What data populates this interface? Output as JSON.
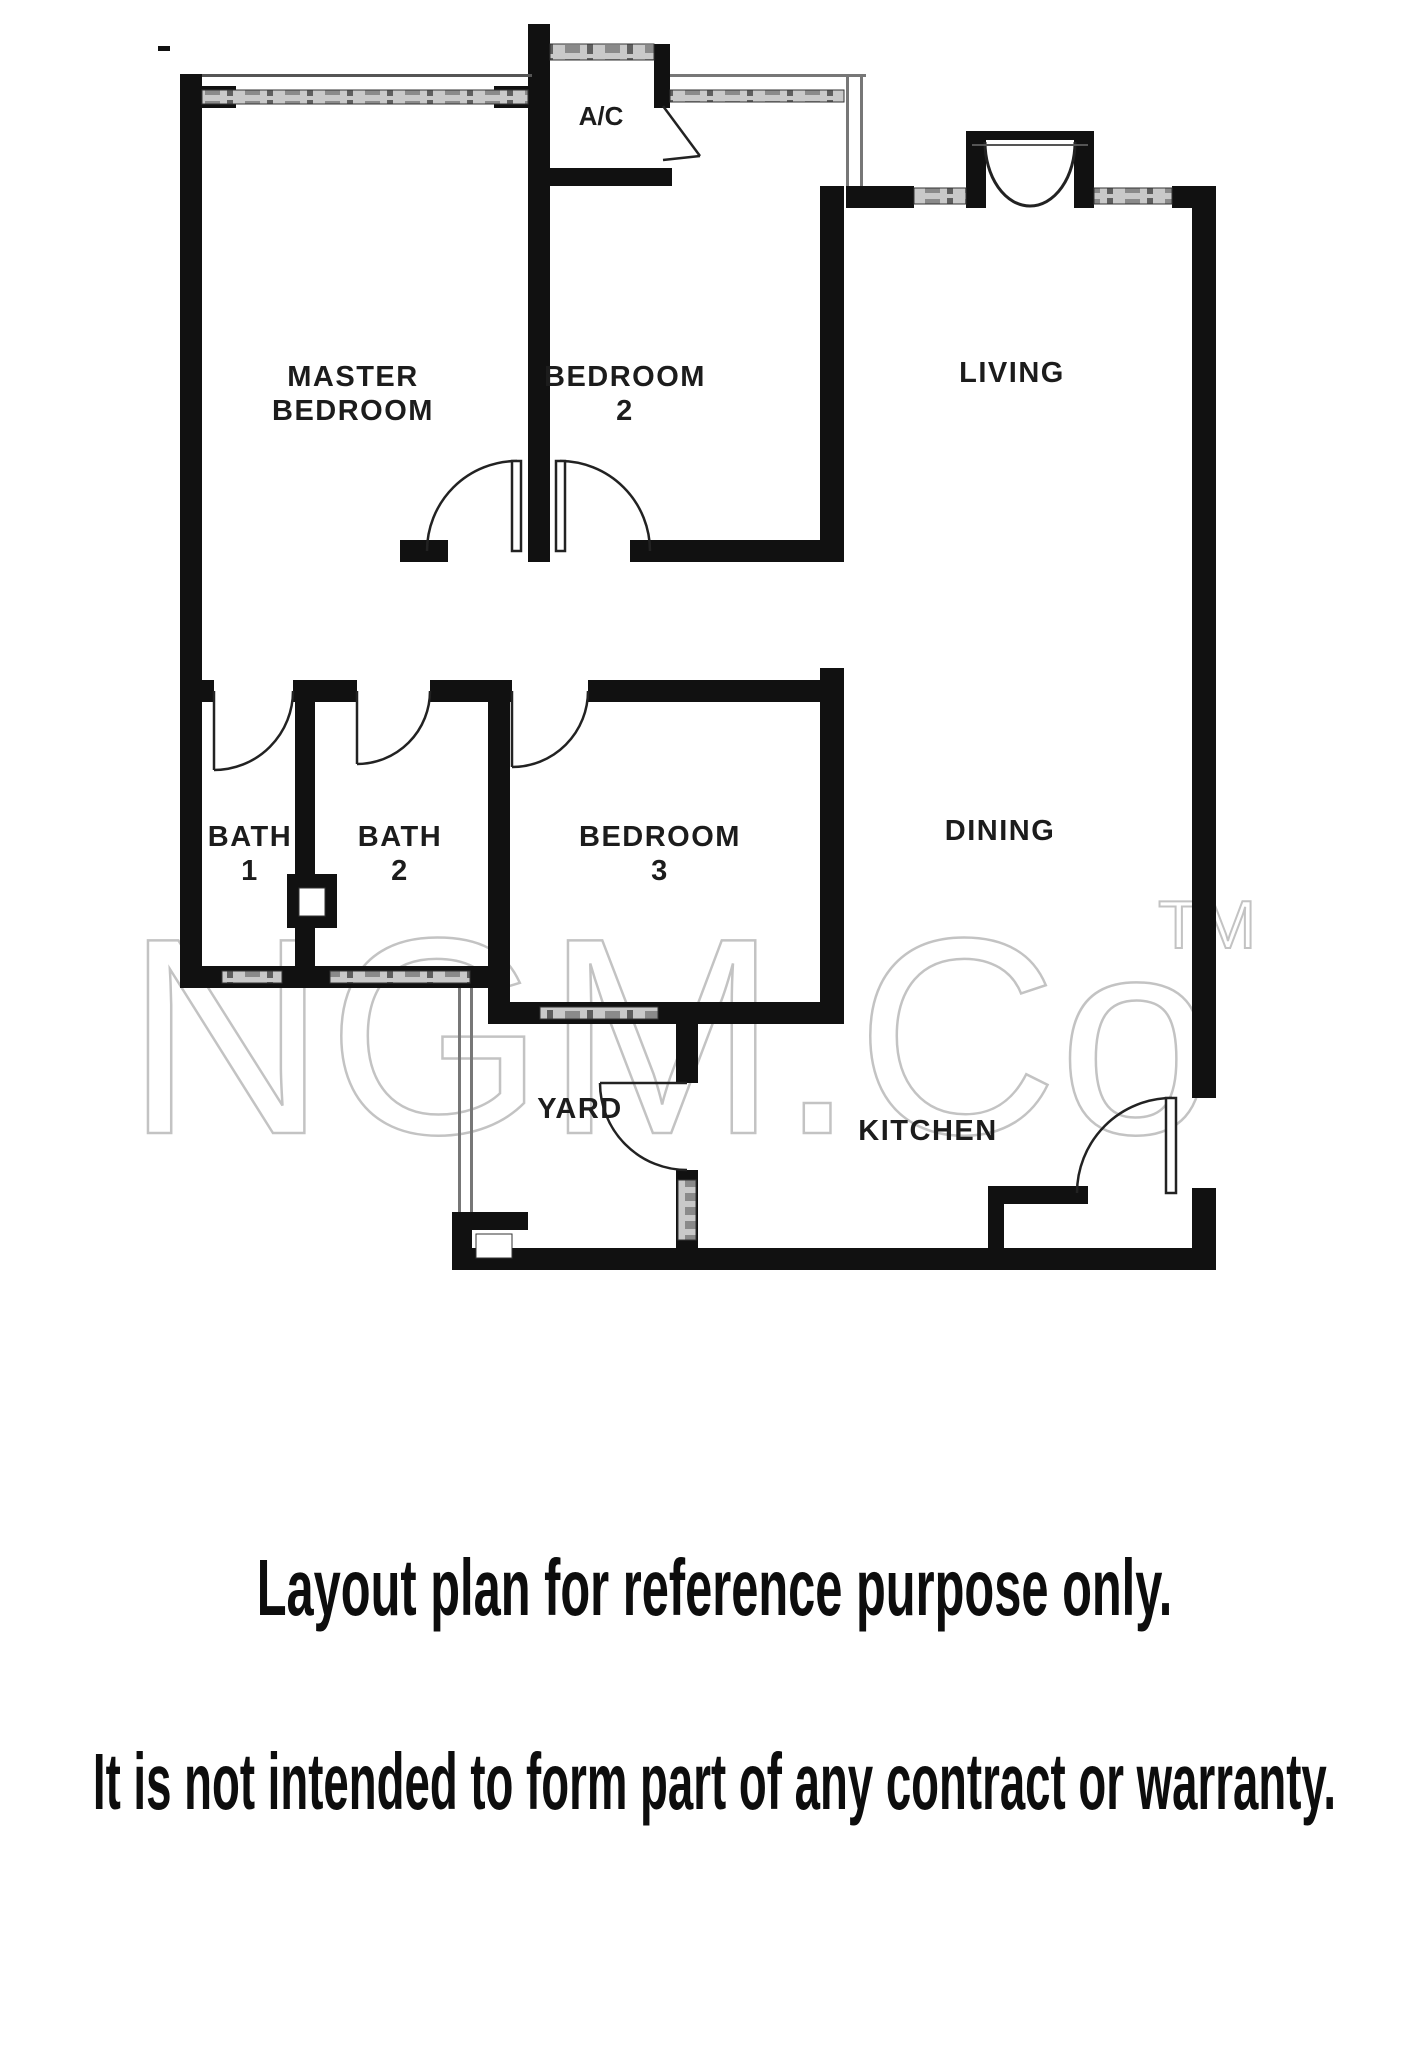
{
  "plan": {
    "ac_label": "A/C",
    "rooms": {
      "master_bedroom": {
        "line1": "MASTER",
        "line2": "BEDROOM"
      },
      "bedroom2": {
        "line1": "BEDROOM",
        "line2": "2"
      },
      "living": {
        "label": "LIVING"
      },
      "bath1": {
        "line1": "BATH",
        "line2": "1"
      },
      "bath2": {
        "line1": "BATH",
        "line2": "2"
      },
      "bedroom3": {
        "line1": "BEDROOM",
        "line2": "3"
      },
      "dining": {
        "label": "DINING"
      },
      "yard": {
        "label": "YARD"
      },
      "kitchen": {
        "label": "KITCHEN"
      }
    }
  },
  "watermark": {
    "text": "NGM.Co",
    "tm": "TM",
    "color": "#c3c3c3"
  },
  "captions": {
    "line1": "Layout plan for reference purpose only.",
    "line2": "It is not intended to form part of any contract or warranty."
  },
  "colors": {
    "wall": "#111111",
    "window": "#c9c9c9",
    "text": "#1c1c1c",
    "background": "#ffffff"
  }
}
